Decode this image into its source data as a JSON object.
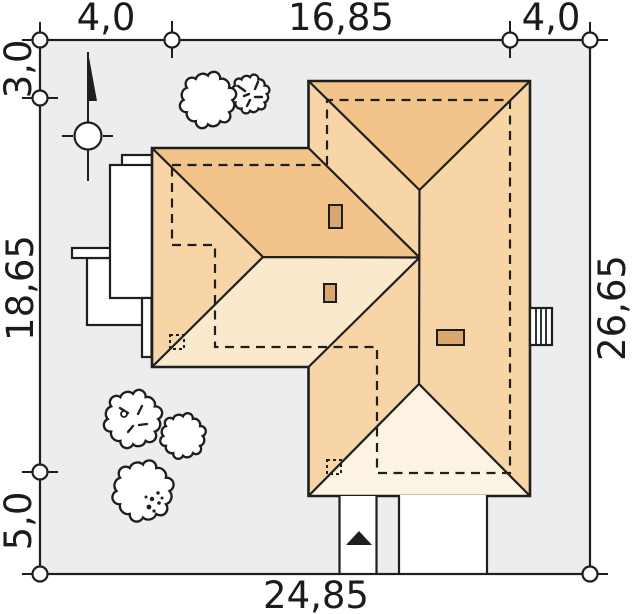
{
  "title": "House site plan with plot dimensions",
  "dimensions": {
    "top_left": "4,0",
    "top_middle": "16,85",
    "top_right": "4,0",
    "left_top": "3,0",
    "left_middle": "18,65",
    "left_bottom": "5,0",
    "right_side": "26,65",
    "bottom": "24,85"
  },
  "colors": {
    "plot_bg": "#ecedee",
    "line": "#1e1e1e",
    "roof_north": "#f2c489",
    "roof_side": "#f7d5a6",
    "roof_south_wing": "#fae9cc",
    "roof_south_main": "#fdf3e2",
    "chimney": "#d7a76d",
    "white": "#ffffff"
  },
  "icons": {
    "north_arrow": "north-arrow-icon",
    "entrance_arrow": "entrance-arrow-icon",
    "tree": "tree-icon",
    "dimension_marker": "circle-marker-icon"
  },
  "counts": {
    "trees": 5,
    "chimneys": 3,
    "boundary_markers": 8
  }
}
